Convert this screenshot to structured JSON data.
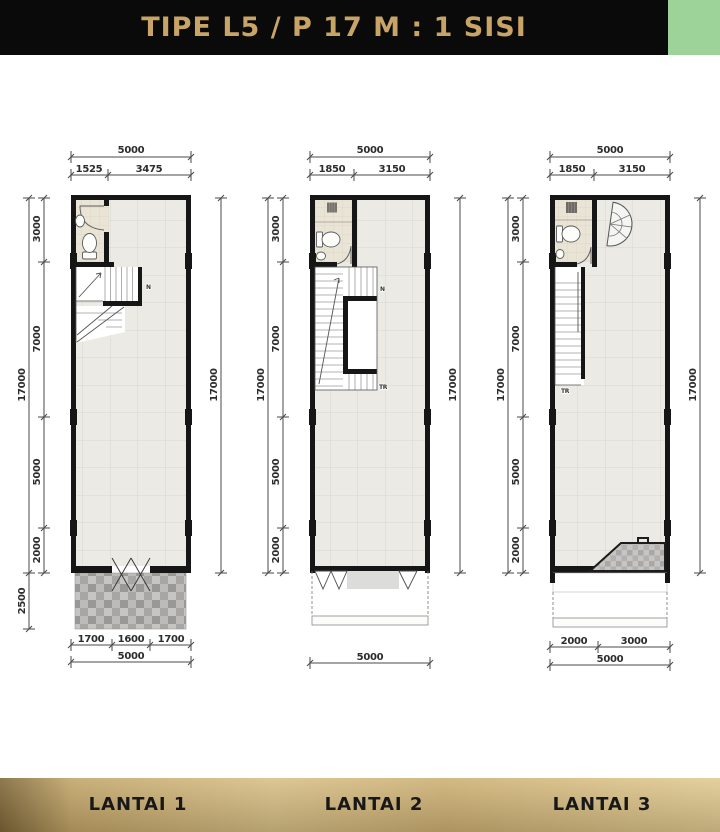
{
  "title": "TIPE L5 / P 17 M : 1 SISI",
  "colors": {
    "banner_bg": "#0a0a0a",
    "title_gold": "#c8a467",
    "accent_green": "#9dd399",
    "footer_gold": "#d8bf85"
  },
  "floors": [
    {
      "label": "LANTAI 1",
      "dims": {
        "width_total": "5000",
        "width_splits": [
          "1525",
          "3475"
        ],
        "height_total": "17000",
        "height_splits": [
          "3000",
          "7000",
          "5000",
          "2000"
        ],
        "carport_depth": "2500",
        "bottom_splits": [
          "1700",
          "1600",
          "1700"
        ],
        "bottom_total": "5000"
      },
      "stair_up_label": "N"
    },
    {
      "label": "LANTAI 2",
      "dims": {
        "width_total": "5000",
        "width_splits": [
          "1850",
          "3150"
        ],
        "height_total": "17000",
        "height_splits": [
          "3000",
          "7000",
          "5000",
          "2000"
        ],
        "bottom_total": "5000"
      },
      "stair_up_label": "N",
      "stair_down_label": "TR"
    },
    {
      "label": "LANTAI 3",
      "dims": {
        "width_total": "5000",
        "width_splits": [
          "1850",
          "3150"
        ],
        "height_total": "17000",
        "height_splits": [
          "3000",
          "7000",
          "5000",
          "2000"
        ],
        "bottom_splits": [
          "2000",
          "3000"
        ],
        "bottom_total": "5000"
      },
      "stair_down_label": "TR"
    }
  ]
}
